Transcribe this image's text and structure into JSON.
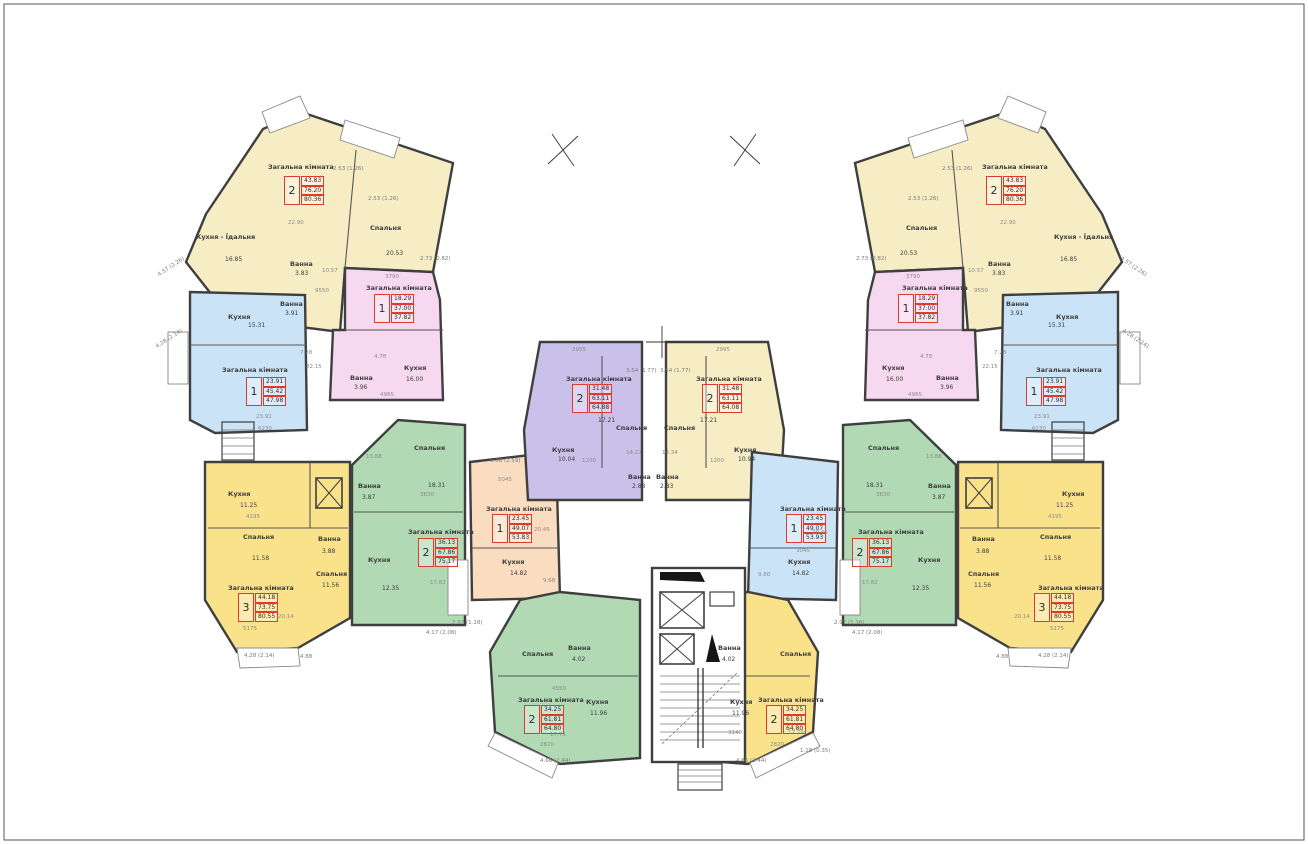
{
  "drawing": {
    "type": "apartment-building-floor-plan",
    "room_label_living": "Загальна кімната"
  },
  "colors": {
    "cream": "#f7edc5",
    "pink": "#f6d8f0",
    "blue": "#cbe3f6",
    "yellow": "#fae28b",
    "green": "#b0d9b4",
    "purple": "#cac1ea",
    "peach": "#fadcc0",
    "wall": "#3f3f3f",
    "apartment_box_red": "#e03a2e"
  },
  "units": {
    "l1": {
      "label": "Загальна кімната",
      "box": {
        "num": "2",
        "a1": "43.83",
        "a2": "76.20",
        "a3": "80.36"
      },
      "rooms": [
        {
          "n": "Кухня - Їдальня",
          "a": "16.85"
        },
        {
          "n": "Спальня",
          "a": "20.53"
        },
        {
          "n": "Ванна",
          "a": "3.83"
        }
      ],
      "dims": [
        "22.90",
        "10.57",
        "9550"
      ],
      "balc": [
        "2.53 (1.26)",
        "2.53 (1.26)",
        "4.57 (2.26)",
        "2.73 (0.82)"
      ]
    },
    "l2": {
      "label": "Загальна кімната",
      "box": {
        "num": "1",
        "a1": "18.29",
        "a2": "37.00",
        "a3": "37.82"
      },
      "rooms": [
        {
          "n": "Кухня",
          "a": "16.00"
        },
        {
          "n": "Ванна",
          "a": "3.96"
        }
      ],
      "dims": [
        "3790",
        "4985",
        "4.78"
      ],
      "balc": []
    },
    "l3": {
      "label": "Загальна кімната",
      "box": {
        "num": "1",
        "a1": "23.91",
        "a2": "45.42",
        "a3": "47.98"
      },
      "rooms": [
        {
          "n": "Кухня",
          "a": "15.31"
        },
        {
          "n": "Ванна",
          "a": "3.91"
        }
      ],
      "dims": [
        "23.91",
        "6230",
        "7.28",
        "22.15"
      ],
      "balc": [
        "4.28 (2.14)"
      ]
    },
    "l4": {
      "label": "Загальна кімната",
      "box": {
        "num": "3",
        "a1": "44.18",
        "a2": "73.75",
        "a3": "80.55"
      },
      "rooms": [
        {
          "n": "Кухня",
          "a": "11.25"
        },
        {
          "n": "Спальня",
          "a": "11.58"
        },
        {
          "n": "Ванна",
          "a": "3.88"
        },
        {
          "n": "Спальня",
          "a": "11.56"
        }
      ],
      "dims": [
        "20.14",
        "4195",
        "5175"
      ],
      "balc": [
        "4.28 (2.14)",
        "4.88"
      ]
    },
    "l5": {
      "label": "Загальна кімната",
      "box": {
        "num": "2",
        "a1": "36.13",
        "a2": "67.86",
        "a3": "75.17"
      },
      "rooms": [
        {
          "n": "Спальня",
          "a": "18.31"
        },
        {
          "n": "Кухня",
          "a": "12.35"
        },
        {
          "n": "Ванна",
          "a": "3.87"
        }
      ],
      "dims": [
        "13.88",
        "17.82",
        "3830"
      ],
      "balc": [
        "4.17 (2.08)"
      ]
    },
    "c1": {
      "label": "Загальна кімната",
      "box": {
        "num": "1",
        "a1": "23.45",
        "a2": "49.07",
        "a3": "53.83"
      },
      "rooms": [
        {
          "n": "Кухня",
          "a": "14.82"
        }
      ],
      "dims": [
        "20.45",
        "9.68",
        "5045"
      ],
      "balc": [
        "5.08 (2.59)",
        "2.97 (1.18)"
      ]
    },
    "c2": {
      "label": "Загальна кімната",
      "box": {
        "num": "2",
        "a1": "31.48",
        "a2": "63.11",
        "a3": "64.88"
      },
      "rooms": [
        {
          "n": "Спальня",
          "a": "17.21"
        },
        {
          "n": "Кухня",
          "a": "10.04"
        },
        {
          "n": "Ванна",
          "a": "2.83"
        }
      ],
      "dims": [
        "2995",
        "1200",
        "14.27"
      ],
      "balc": [
        "3.54 (1.77)"
      ]
    },
    "c3": {
      "label": "Загальна кімната",
      "box": {
        "num": "2",
        "a1": "31.48",
        "a2": "63.11",
        "a3": "64.08"
      },
      "rooms": [
        {
          "n": "Спальня",
          "a": "17.21"
        },
        {
          "n": "Кухня",
          "a": "10.94"
        },
        {
          "n": "Ванна",
          "a": "2.83"
        }
      ],
      "dims": [
        "2995",
        "1200",
        "14.34"
      ],
      "balc": [
        "3.54 (1.77)"
      ]
    },
    "c4": {
      "label": "Загальна кімната",
      "box": {
        "num": "1",
        "a1": "23.45",
        "a2": "49.07",
        "a3": "53.93"
      },
      "rooms": [
        {
          "n": "Кухня",
          "a": "14.82"
        }
      ],
      "dims": [
        "20.45",
        "9.60",
        "3045"
      ],
      "balc": [
        "2.97 (1.16)"
      ]
    },
    "c5": {
      "label": "Загальна кімната",
      "box": {
        "num": "2",
        "a1": "34.25",
        "a2": "61.81",
        "a3": "64.80"
      },
      "rooms": [
        {
          "n": "Спальня",
          "a": ""
        },
        {
          "n": "Ванна",
          "a": "4.02"
        },
        {
          "n": "Кухня",
          "a": "11.96"
        }
      ],
      "dims": [
        "17.79",
        "2820",
        "4550"
      ],
      "balc": [
        "4.66 (2.44)"
      ]
    },
    "c6": {
      "label": "Загальна кімната",
      "box": {
        "num": "2",
        "a1": "34.25",
        "a2": "61.81",
        "a3": "64.80"
      },
      "rooms": [
        {
          "n": "Спальня",
          "a": ""
        },
        {
          "n": "Ванна",
          "a": "4.02"
        },
        {
          "n": "Кухня",
          "a": "11.96"
        }
      ],
      "dims": [
        "17.79",
        "2820",
        "3140"
      ],
      "balc": [
        "4.66 (2.44)",
        "1.18 (0.35)"
      ]
    },
    "r1": {
      "label": "Загальна кімната",
      "box": {
        "num": "2",
        "a1": "43.83",
        "a2": "76.20",
        "a3": "80.36"
      },
      "rooms": [
        {
          "n": "Кухня - Їдальня",
          "a": "16.85"
        },
        {
          "n": "Спальня",
          "a": "20.53"
        },
        {
          "n": "Ванна",
          "a": "3.83"
        }
      ],
      "dims": [
        "22.90",
        "10.57",
        "9550"
      ],
      "balc": [
        "2.53 (1.26)",
        "2.53 (1.26)",
        "4.57 (2.26)",
        "2.73 (0.82)"
      ]
    },
    "r2": {
      "label": "Загальна кімната",
      "box": {
        "num": "1",
        "a1": "18.29",
        "a2": "37.00",
        "a3": "37.82"
      },
      "rooms": [
        {
          "n": "Кухня",
          "a": "16.00"
        },
        {
          "n": "Ванна",
          "a": "3.96"
        }
      ],
      "dims": [
        "3790",
        "4985",
        "4.78"
      ],
      "balc": []
    },
    "r3": {
      "label": "Загальна кімната",
      "box": {
        "num": "1",
        "a1": "23.91",
        "a2": "45.42",
        "a3": "47.98"
      },
      "rooms": [
        {
          "n": "Кухня",
          "a": "15.31"
        },
        {
          "n": "Ванна",
          "a": "3.91"
        }
      ],
      "dims": [
        "23.91",
        "6230",
        "7.28",
        "22.15"
      ],
      "balc": [
        "4.28 (2.14)"
      ]
    },
    "r4": {
      "label": "Загальна кімната",
      "box": {
        "num": "3",
        "a1": "44.18",
        "a2": "73.75",
        "a3": "80.55"
      },
      "rooms": [
        {
          "n": "Кухня",
          "a": "11.25"
        },
        {
          "n": "Спальня",
          "a": "11.58"
        },
        {
          "n": "Ванна",
          "a": "3.88"
        },
        {
          "n": "Спальня",
          "a": "11.56"
        }
      ],
      "dims": [
        "20.14",
        "4195",
        "5175"
      ],
      "balc": [
        "4.28 (2.14)",
        "4.88"
      ]
    },
    "r5": {
      "label": "Загальна кімната",
      "box": {
        "num": "2",
        "a1": "36.13",
        "a2": "67.86",
        "a3": "75.17"
      },
      "rooms": [
        {
          "n": "Спальня",
          "a": "18.31"
        },
        {
          "n": "Кухня",
          "a": "12.35"
        },
        {
          "n": "Ванна",
          "a": "3.87"
        }
      ],
      "dims": [
        "13.88",
        "17.82",
        "3830"
      ],
      "balc": [
        "4.17 (2.08)"
      ]
    }
  }
}
